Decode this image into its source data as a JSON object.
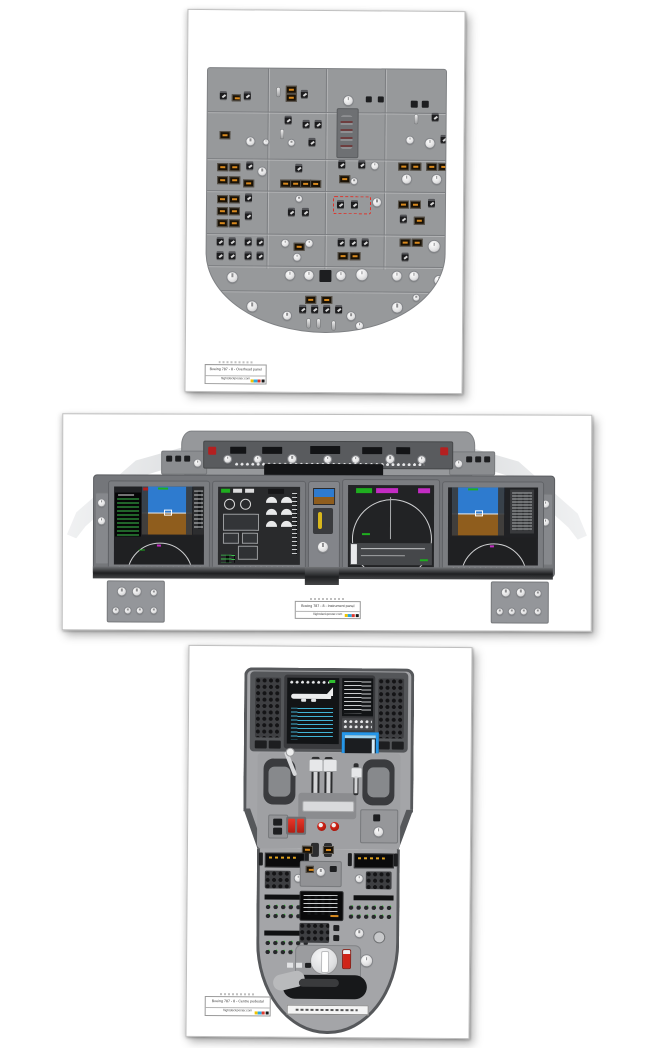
{
  "page": {
    "background": "#ffffff"
  },
  "posters": [
    {
      "id": "overhead",
      "title": "Boeing 787 - 8   -   Overhead panel",
      "brand": "flightdeckposter.com"
    },
    {
      "id": "instrument",
      "title": "Boeing 787 - 8   -   Instrument panel",
      "brand": "flightdeckposter.com"
    },
    {
      "id": "pedestal",
      "title": "Boeing 787 - 8   -   Centre pedestal",
      "brand": "flightdeckposter.com"
    }
  ],
  "print_marks": {
    "colors": [
      "#f2c400",
      "#2da8e0",
      "#e03a2e",
      "#1a1a1a"
    ]
  },
  "palette": {
    "panel_grey": "#97999b",
    "warning_red": "#d02418",
    "caution_amber": "#d98a1e",
    "pfd_sky_blue": "#2e7bcf",
    "pfd_ground_brown": "#8f5d1d",
    "nd_green": "#1fae1f",
    "nd_magenta": "#c32cc3",
    "cdu_cyan": "#46c6ea",
    "window_blue": "#2596e8"
  }
}
